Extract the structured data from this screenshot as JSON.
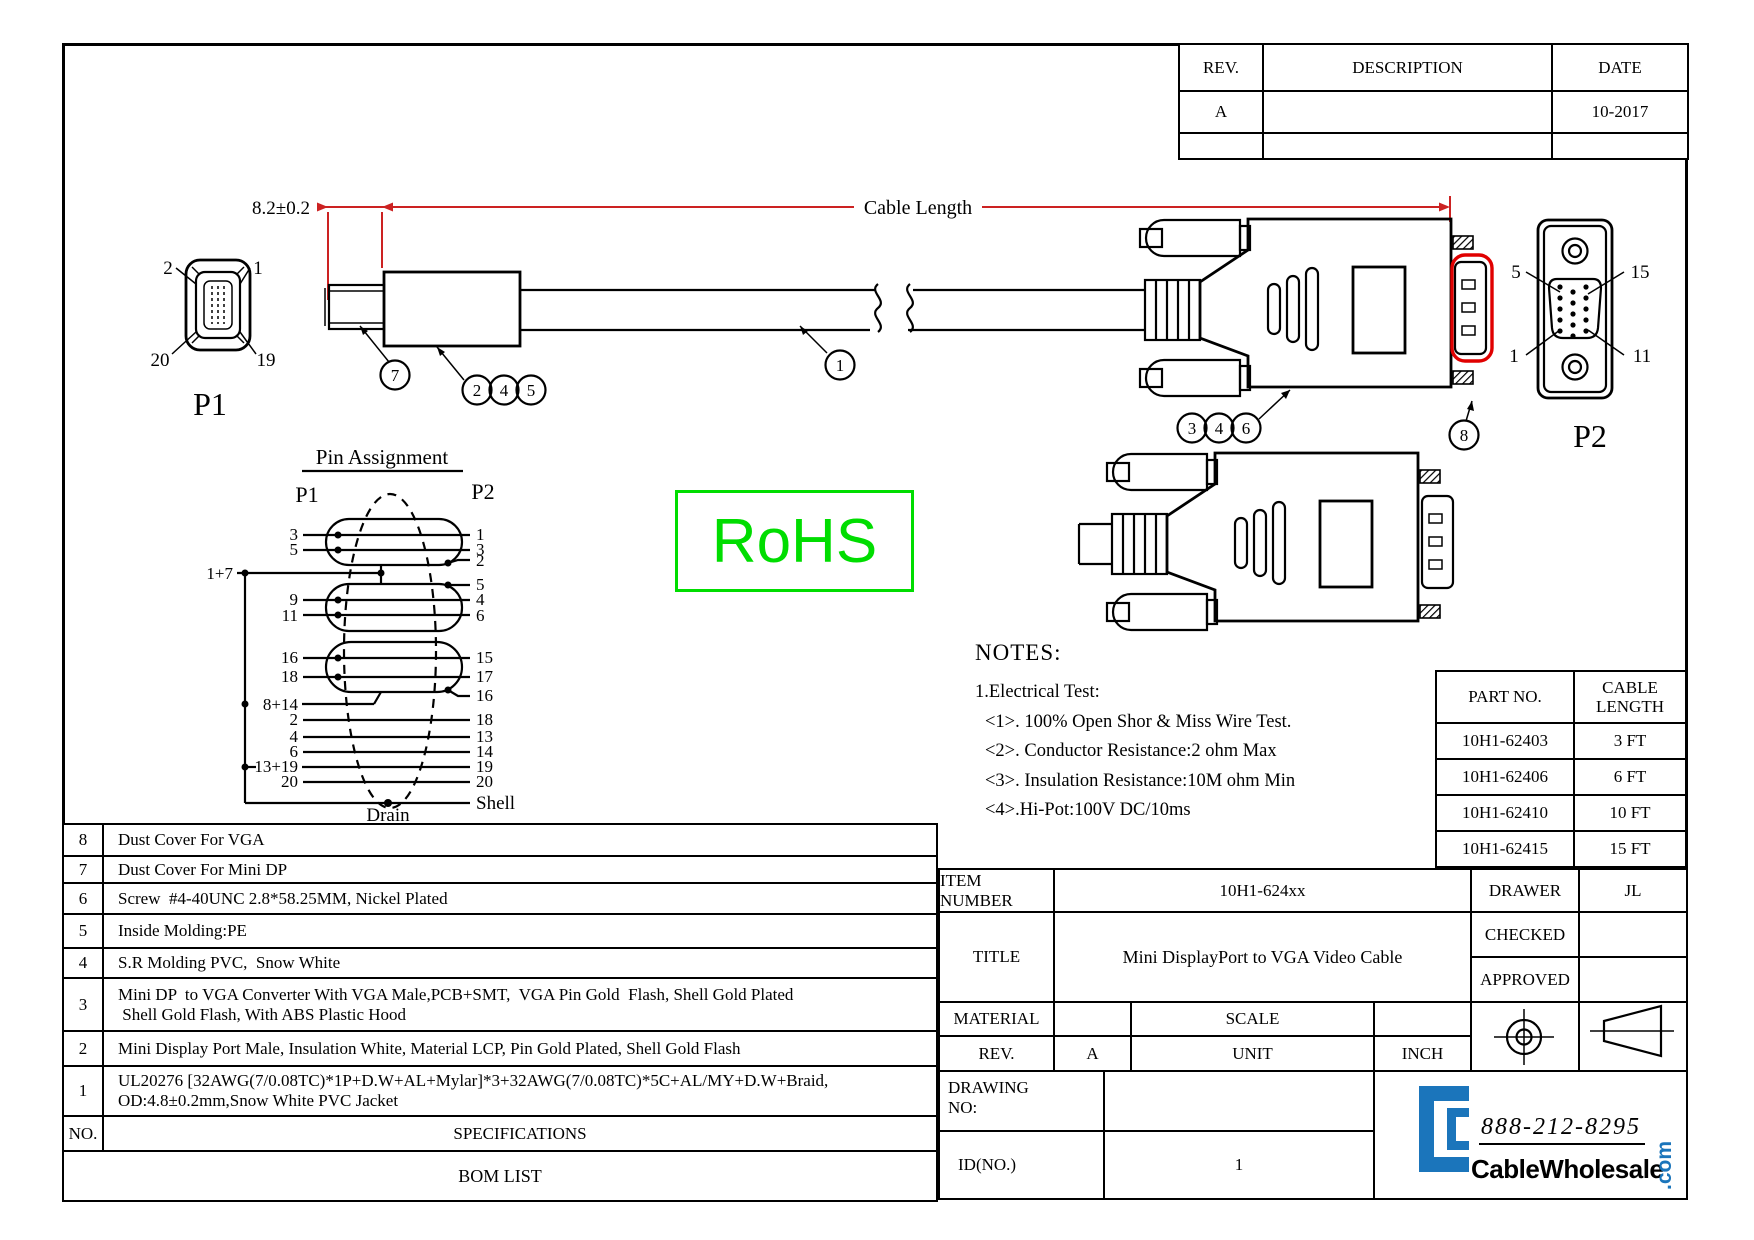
{
  "revision_table": {
    "rev_header": "REV.",
    "description_header": "DESCRIPTION",
    "date_header": "DATE",
    "rev": "A",
    "date": "10-2017"
  },
  "dimensions": {
    "plug": "8.2±0.2",
    "cable": "Cable Length"
  },
  "p1": {
    "caption": "P1",
    "pin_top_left": "2",
    "pin_top_right": "1",
    "pin_bottom_left": "20",
    "pin_bottom_right": "19"
  },
  "p2": {
    "caption": "P2",
    "pin_top_left": "5",
    "pin_top_right": "15",
    "pin_bottom_left": "1",
    "pin_bottom_right": "11"
  },
  "callouts": [
    "7",
    "2",
    "4",
    "5",
    "1",
    "3",
    "4",
    "6",
    "8"
  ],
  "rohs": "RoHS",
  "pin_assignment": {
    "heading": "Pin Assignment",
    "p1": "P1",
    "p2": "P2",
    "left": [
      "3",
      "5",
      "1+7",
      "9",
      "11",
      "16",
      "18",
      "8+14",
      "2",
      "4",
      "6",
      "13+19",
      "20"
    ],
    "right": [
      "1",
      "3",
      "2",
      "5",
      "4",
      "6",
      "15",
      "17",
      "16",
      "18",
      "13",
      "14",
      "19",
      "20",
      "Shell"
    ],
    "drain": "Drain"
  },
  "notes": {
    "heading": "NOTES:",
    "lines": [
      "1.Electrical Test:",
      "<1>. 100% Open Shor & Miss Wire Test.",
      "<2>. Conductor Resistance:2 ohm Max",
      "<3>. Insulation Resistance:10M ohm Min",
      "<4>.Hi-Pot:100V DC/10ms"
    ]
  },
  "part_table": {
    "col1": "PART NO.",
    "col2": "CABLE LENGTH",
    "rows": [
      [
        "10H1-62403",
        "3 FT"
      ],
      [
        "10H1-62406",
        "6 FT"
      ],
      [
        "10H1-62410",
        "10 FT"
      ],
      [
        "10H1-62415",
        "15 FT"
      ]
    ]
  },
  "bom": {
    "no_header": "NO.",
    "spec_header": "SPECIFICATIONS",
    "footer": "BOM LIST",
    "rows": [
      {
        "no": "8",
        "lines": [
          "Dust Cover For VGA"
        ]
      },
      {
        "no": "7",
        "lines": [
          "Dust Cover For Mini DP"
        ]
      },
      {
        "no": "6",
        "lines": [
          "Screw  #4-40UNC 2.8*58.25MM, Nickel Plated"
        ]
      },
      {
        "no": "5",
        "lines": [
          "Inside Molding:PE"
        ]
      },
      {
        "no": "4",
        "lines": [
          "S.R Molding PVC,  Snow White"
        ]
      },
      {
        "no": "3",
        "lines": [
          "Mini DP  to VGA Converter With VGA Male,PCB+SMT,  VGA Pin Gold  Flash, Shell Gold Plated",
          " Shell Gold Flash, With ABS Plastic Hood"
        ]
      },
      {
        "no": "2",
        "lines": [
          "Mini Display Port Male, Insulation White, Material LCP, Pin Gold Plated, Shell Gold Flash"
        ]
      },
      {
        "no": "1",
        "lines": [
          "UL20276 [32AWG(7/0.08TC)*1P+D.W+AL+Mylar]*3+32AWG(7/0.08TC)*5C+AL/MY+D.W+Braid,",
          "OD:4.8±0.2mm,Snow White PVC Jacket"
        ]
      }
    ]
  },
  "title_block": {
    "item_number_label": "ITEM NUMBER",
    "item_number": "10H1-624xx",
    "drawer_label": "DRAWER",
    "drawer": "JL",
    "title_label": "TITLE",
    "title": "Mini DisplayPort to VGA Video Cable",
    "checked_label": "CHECKED",
    "approved_label": "APPROVED",
    "material_label": "MATERIAL",
    "scale_label": "SCALE",
    "rev_label": "REV.",
    "rev": "A",
    "unit_label": "UNIT",
    "unit": "INCH",
    "drawing_no_label": "DRAWING NO:",
    "id_label": "ID(NO.)",
    "id": "1"
  },
  "logo": {
    "phone": "888-212-8295",
    "name": "CableWholesale",
    "tld": ".com",
    "blue": "#1b75bb"
  }
}
